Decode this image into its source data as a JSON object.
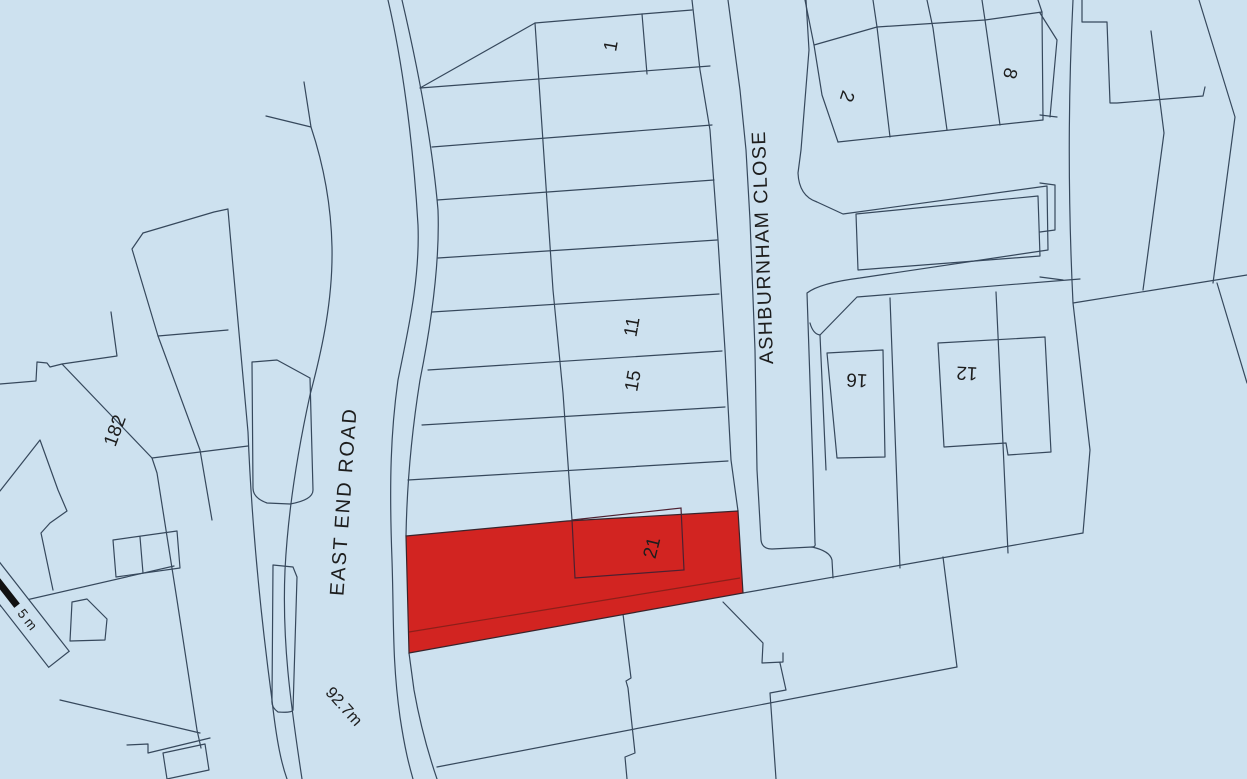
{
  "map": {
    "colors": {
      "background": "#cde1ef",
      "line": "#36485c",
      "site_fill": "#d22421",
      "site_outline": "#38242c",
      "site_inner_line": "#8c1f1a",
      "site_building_line": "#4d2030",
      "label_text": "#1d1d1d",
      "scale_bar": "#111111"
    },
    "street_labels": {
      "east_end_road": "EAST END ROAD",
      "ashburnham_close": "ASHBURNHAM CLOSE"
    },
    "plot_labels": {
      "p1": "1",
      "p2": "2",
      "p8": "8",
      "p11": "11",
      "p12": "12",
      "p15": "15",
      "p16": "16",
      "p21": "21",
      "p182": "182"
    },
    "spot_height": "92.7m",
    "scale_bar": {
      "label": "5 m"
    },
    "site": {
      "plot_number": "21",
      "polygon": "406,536 567,521 705,513 738,511 743,593 409,653"
    }
  }
}
